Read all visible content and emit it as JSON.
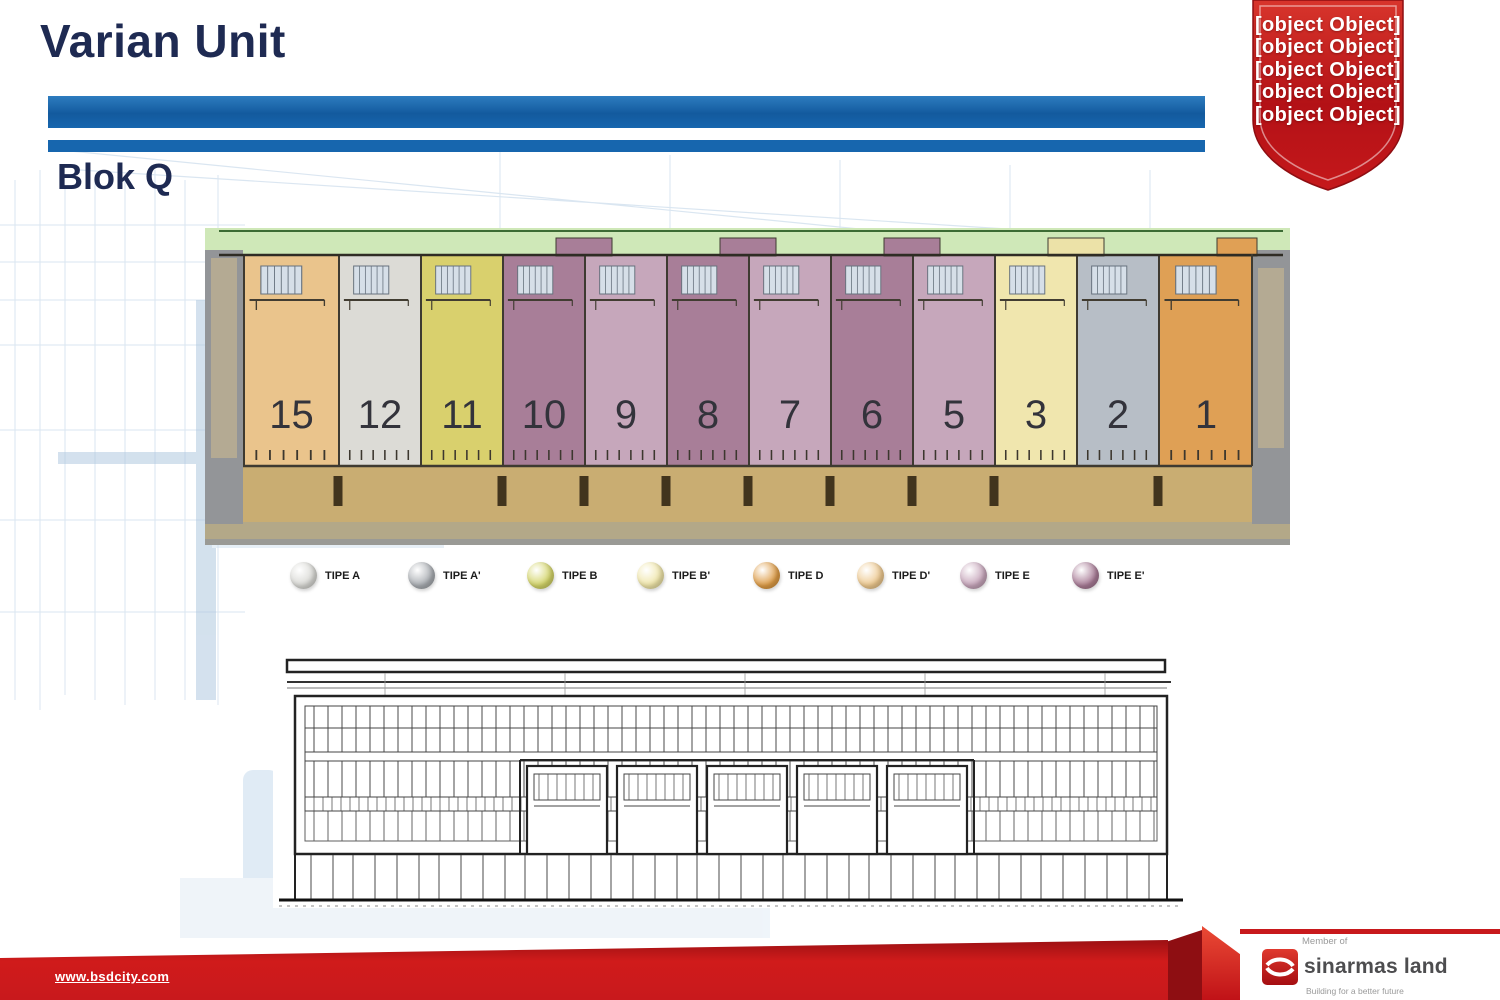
{
  "header": {
    "title": "Varian Unit",
    "block": "Blok Q"
  },
  "badge": {
    "lines": [
      "NEW",
      "BUSINESS",
      "PARK",
      "IN",
      "BSD CITY"
    ]
  },
  "floorplan": {
    "units": [
      {
        "number": "15",
        "type": "TIPE D'",
        "color": "#eac48c",
        "x": 38,
        "w": 95
      },
      {
        "number": "12",
        "type": "TIPE A",
        "color": "#dcdbd6",
        "x": 133,
        "w": 82
      },
      {
        "number": "11",
        "type": "TIPE B",
        "color": "#d9d06d",
        "x": 215,
        "w": 82
      },
      {
        "number": "10",
        "type": "TIPE E'",
        "color": "#a87e98",
        "x": 297,
        "w": 82
      },
      {
        "number": "9",
        "type": "TIPE E",
        "color": "#c6a7bb",
        "x": 379,
        "w": 82
      },
      {
        "number": "8",
        "type": "TIPE E'",
        "color": "#a87e98",
        "x": 461,
        "w": 82
      },
      {
        "number": "7",
        "type": "TIPE E",
        "color": "#c6a7bb",
        "x": 543,
        "w": 82
      },
      {
        "number": "6",
        "type": "TIPE E'",
        "color": "#a87e98",
        "x": 625,
        "w": 82
      },
      {
        "number": "5",
        "type": "TIPE E",
        "color": "#c6a7bb",
        "x": 707,
        "w": 82
      },
      {
        "number": "3",
        "type": "TIPE B'",
        "color": "#f0e6ae",
        "x": 789,
        "w": 82
      },
      {
        "number": "2",
        "type": "TIPE A'",
        "color": "#b7bec6",
        "x": 871,
        "w": 82
      },
      {
        "number": "1",
        "type": "TIPE D",
        "color": "#dfa055",
        "x": 953,
        "w": 94
      }
    ]
  },
  "legend": {
    "items": [
      {
        "label": "TIPE A",
        "color": "#d8d8d4",
        "x": 290
      },
      {
        "label": "TIPE A'",
        "color": "#a9adb2",
        "x": 408
      },
      {
        "label": "TIPE B",
        "color": "#d3d468",
        "x": 527
      },
      {
        "label": "TIPE B'",
        "color": "#efe5a8",
        "x": 637
      },
      {
        "label": "TIPE D",
        "color": "#dd9b45",
        "x": 753
      },
      {
        "label": "TIPE D'",
        "color": "#edc88e",
        "x": 857
      },
      {
        "label": "TIPE E",
        "color": "#c6a5ba",
        "x": 960
      },
      {
        "label": "TIPE E'",
        "color": "#a87b96",
        "x": 1072
      }
    ]
  },
  "footer": {
    "website": "www.bsdcity.com",
    "member_of": "Member of",
    "brand": "sinarmas land",
    "tagline": "Building for a better future"
  },
  "palette": {
    "bar_blue": "#1766ae",
    "title_navy": "#1e2a52",
    "badge_red": "#c41518",
    "footer_red": "#c8191c",
    "plan_green": "#cfe8b8",
    "plan_road": "#c9ad72",
    "plan_wall_gray": "#939598"
  }
}
